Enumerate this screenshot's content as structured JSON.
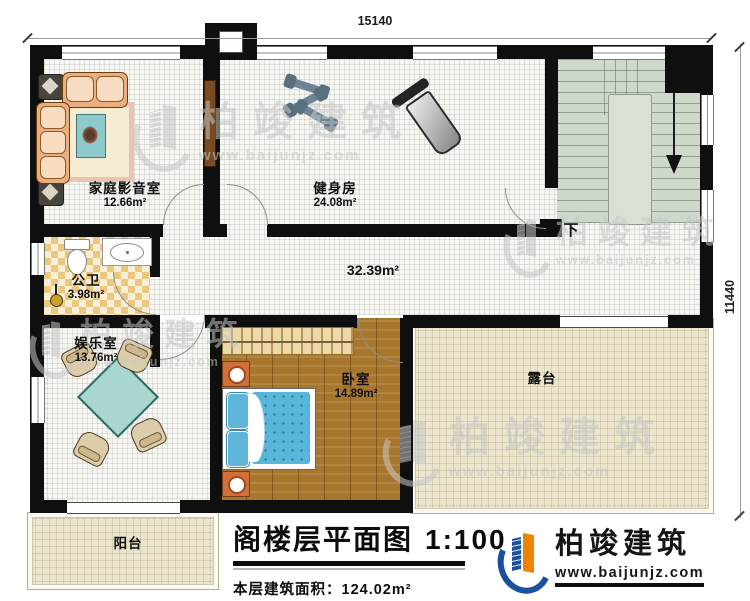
{
  "dimensions": {
    "top": "15140",
    "right": "11440"
  },
  "rooms": {
    "home_theater": {
      "name": "家庭影音室",
      "area": "12.66m²"
    },
    "gym": {
      "name": "健身房",
      "area": "24.08m²"
    },
    "bathroom": {
      "name": "公卫",
      "area": "3.98m²"
    },
    "entertainment": {
      "name": "娱乐室",
      "area": "13.76m²"
    },
    "bedroom": {
      "name": "卧室",
      "area": "14.89m²"
    },
    "hallway": {
      "area": "32.39m²"
    },
    "terrace": {
      "name": "露台"
    },
    "balcony": {
      "name": "阳台"
    },
    "stairs": {
      "down_label": "下"
    }
  },
  "title_block": {
    "title": "阁楼层平面图",
    "scale": "1:100",
    "area_label": "本层建筑面积：",
    "area_value": "124.02m²"
  },
  "logo": {
    "name": "柏竣建筑",
    "url": "www.baijunjz.com"
  },
  "watermark": {
    "name": "柏竣建筑",
    "url": "www.baijunjz.com"
  },
  "colors": {
    "wall": "#0f0f0f",
    "tile_floor": "#f6f6f3",
    "outdoor_floor": "#ebe5cd",
    "stairs_floor": "#cfd9cb",
    "bathroom_tile": "#eac87f",
    "wood_floor": "#a8772f",
    "bed_blue": "#58b5da",
    "table_teal": "#a9d6cf",
    "logo_blue": "#1b4f9f",
    "logo_orange": "#f08300"
  }
}
